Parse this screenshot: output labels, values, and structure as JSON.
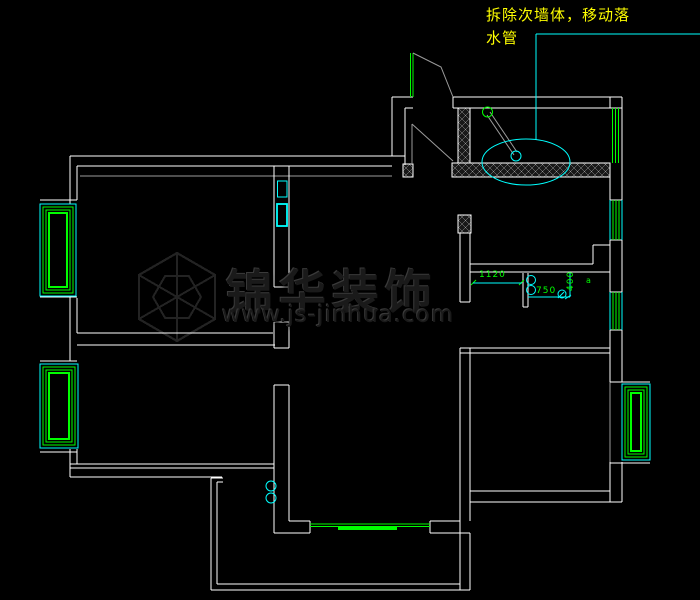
{
  "annotation": {
    "line1": "拆除次墙体，移动落",
    "line2": "水管",
    "color": "#ffff00"
  },
  "watermark": {
    "title": "锦华装饰",
    "url": "www.js-jinhua.com",
    "logo": {
      "cx": 177,
      "cy": 297,
      "r": 44,
      "r2": 24
    }
  },
  "dims": {
    "d1": "1120",
    "d2": "750",
    "d3": "400",
    "marker": "a"
  },
  "colors": {
    "background": "#000000",
    "wall": "#ffffff",
    "window_green": "#00ff00",
    "cyan": "#00ffff",
    "yellow": "#ffff00",
    "dim_text": "#00ff00",
    "gray": "#9c9c9c",
    "watermark": "#232323",
    "hatch": "#b5b5b5"
  },
  "plan": {
    "lines": [
      {
        "x1": 70,
        "y1": 156,
        "x2": 405,
        "y2": 156
      },
      {
        "x1": 77,
        "y1": 166,
        "x2": 392,
        "y2": 166
      },
      {
        "x1": 70,
        "y1": 156,
        "x2": 70,
        "y2": 204
      },
      {
        "x1": 77,
        "y1": 166,
        "x2": 77,
        "y2": 200
      },
      {
        "x1": 80,
        "y1": 176,
        "x2": 392,
        "y2": 176,
        "c": "gray"
      },
      {
        "x1": 70,
        "y1": 296,
        "x2": 70,
        "y2": 361
      },
      {
        "x1": 77,
        "y1": 298,
        "x2": 77,
        "y2": 333
      },
      {
        "x1": 77,
        "y1": 333,
        "x2": 273,
        "y2": 333
      },
      {
        "x1": 77,
        "y1": 345,
        "x2": 275,
        "y2": 345
      },
      {
        "x1": 70,
        "y1": 449,
        "x2": 70,
        "y2": 477
      },
      {
        "x1": 77,
        "y1": 449,
        "x2": 77,
        "y2": 464
      },
      {
        "x1": 70,
        "y1": 464,
        "x2": 274,
        "y2": 464
      },
      {
        "x1": 70,
        "y1": 468,
        "x2": 274,
        "y2": 468
      },
      {
        "x1": 70,
        "y1": 477,
        "x2": 222,
        "y2": 477
      },
      {
        "x1": 40,
        "y1": 200,
        "x2": 77,
        "y2": 200
      },
      {
        "x1": 40,
        "y1": 204,
        "x2": 70,
        "y2": 204
      },
      {
        "x1": 40,
        "y1": 297,
        "x2": 77,
        "y2": 297
      },
      {
        "x1": 40,
        "y1": 361,
        "x2": 77,
        "y2": 361
      },
      {
        "x1": 40,
        "y1": 364,
        "x2": 70,
        "y2": 364
      },
      {
        "x1": 40,
        "y1": 448,
        "x2": 77,
        "y2": 448
      },
      {
        "x1": 40,
        "y1": 452,
        "x2": 77,
        "y2": 452
      },
      {
        "x1": 274,
        "y1": 166,
        "x2": 274,
        "y2": 287
      },
      {
        "x1": 274,
        "y1": 322,
        "x2": 274,
        "y2": 348
      },
      {
        "x1": 274,
        "y1": 385,
        "x2": 274,
        "y2": 533
      },
      {
        "x1": 289,
        "y1": 166,
        "x2": 289,
        "y2": 287
      },
      {
        "x1": 289,
        "y1": 322,
        "x2": 289,
        "y2": 348
      },
      {
        "x1": 289,
        "y1": 385,
        "x2": 289,
        "y2": 521
      },
      {
        "x1": 274,
        "y1": 287,
        "x2": 289,
        "y2": 287
      },
      {
        "x1": 274,
        "y1": 322,
        "x2": 289,
        "y2": 322
      },
      {
        "x1": 274,
        "y1": 348,
        "x2": 289,
        "y2": 348
      },
      {
        "x1": 274,
        "y1": 385,
        "x2": 289,
        "y2": 385
      },
      {
        "x1": 289,
        "y1": 521,
        "x2": 310,
        "y2": 521
      },
      {
        "x1": 274,
        "y1": 533,
        "x2": 310,
        "y2": 533
      },
      {
        "x1": 310,
        "y1": 521,
        "x2": 310,
        "y2": 533
      },
      {
        "x1": 430,
        "y1": 521,
        "x2": 460,
        "y2": 521
      },
      {
        "x1": 430,
        "y1": 533,
        "x2": 470,
        "y2": 533
      },
      {
        "x1": 430,
        "y1": 521,
        "x2": 430,
        "y2": 533
      },
      {
        "x1": 211,
        "y1": 478,
        "x2": 211,
        "y2": 590,
        "n": "balcony-wall"
      },
      {
        "x1": 211,
        "y1": 478,
        "x2": 223,
        "y2": 478
      },
      {
        "x1": 217,
        "y1": 482,
        "x2": 217,
        "y2": 584
      },
      {
        "x1": 217,
        "y1": 482,
        "x2": 223,
        "y2": 482
      },
      {
        "x1": 211,
        "y1": 590,
        "x2": 470,
        "y2": 590,
        "n": "balcony-wall"
      },
      {
        "x1": 217,
        "y1": 584,
        "x2": 460,
        "y2": 584
      },
      {
        "x1": 460,
        "y1": 233,
        "x2": 460,
        "y2": 302
      },
      {
        "x1": 470,
        "y1": 233,
        "x2": 470,
        "y2": 302
      },
      {
        "x1": 460,
        "y1": 302,
        "x2": 470,
        "y2": 302
      },
      {
        "x1": 460,
        "y1": 348,
        "x2": 460,
        "y2": 590
      },
      {
        "x1": 470,
        "y1": 348,
        "x2": 470,
        "y2": 521
      },
      {
        "x1": 470,
        "y1": 533,
        "x2": 470,
        "y2": 590
      },
      {
        "x1": 470,
        "y1": 264,
        "x2": 593,
        "y2": 264
      },
      {
        "x1": 470,
        "y1": 272,
        "x2": 610,
        "y2": 272
      },
      {
        "x1": 593,
        "y1": 245,
        "x2": 593,
        "y2": 264
      },
      {
        "x1": 593,
        "y1": 245,
        "x2": 610,
        "y2": 245
      },
      {
        "x1": 460,
        "y1": 348,
        "x2": 610,
        "y2": 348
      },
      {
        "x1": 460,
        "y1": 353,
        "x2": 610,
        "y2": 353
      },
      {
        "x1": 470,
        "y1": 491,
        "x2": 610,
        "y2": 491
      },
      {
        "x1": 470,
        "y1": 502,
        "x2": 622,
        "y2": 502
      },
      {
        "x1": 610,
        "y1": 491,
        "x2": 610,
        "y2": 502
      },
      {
        "x1": 622,
        "y1": 97,
        "x2": 622,
        "y2": 382
      },
      {
        "x1": 622,
        "y1": 462,
        "x2": 622,
        "y2": 502
      },
      {
        "x1": 610,
        "y1": 97,
        "x2": 610,
        "y2": 108
      },
      {
        "x1": 610,
        "y1": 177,
        "x2": 610,
        "y2": 200
      },
      {
        "x1": 610,
        "y1": 240,
        "x2": 610,
        "y2": 292
      },
      {
        "x1": 610,
        "y1": 330,
        "x2": 610,
        "y2": 382
      },
      {
        "x1": 610,
        "y1": 462,
        "x2": 610,
        "y2": 491
      },
      {
        "x1": 610,
        "y1": 382,
        "x2": 610,
        "y2": 462,
        "c": "gray"
      },
      {
        "x1": 453,
        "y1": 97,
        "x2": 622,
        "y2": 97
      },
      {
        "x1": 453,
        "y1": 97,
        "x2": 453,
        "y2": 108
      },
      {
        "x1": 453,
        "y1": 108,
        "x2": 610,
        "y2": 108
      },
      {
        "x1": 610,
        "y1": 200,
        "x2": 622,
        "y2": 200
      },
      {
        "x1": 610,
        "y1": 240,
        "x2": 622,
        "y2": 240
      },
      {
        "x1": 610,
        "y1": 292,
        "x2": 622,
        "y2": 292
      },
      {
        "x1": 610,
        "y1": 330,
        "x2": 622,
        "y2": 330
      },
      {
        "x1": 610,
        "y1": 108,
        "x2": 622,
        "y2": 108
      },
      {
        "x1": 610,
        "y1": 382,
        "x2": 650,
        "y2": 382
      },
      {
        "x1": 610,
        "y1": 463,
        "x2": 650,
        "y2": 463
      },
      {
        "x1": 392,
        "y1": 97,
        "x2": 392,
        "y2": 156
      },
      {
        "x1": 405,
        "y1": 108,
        "x2": 405,
        "y2": 165
      },
      {
        "x1": 392,
        "y1": 97,
        "x2": 413,
        "y2": 97
      },
      {
        "x1": 405,
        "y1": 108,
        "x2": 413,
        "y2": 108
      },
      {
        "x1": 523,
        "y1": 273,
        "x2": 523,
        "y2": 307
      },
      {
        "x1": 528,
        "y1": 273,
        "x2": 528,
        "y2": 307
      },
      {
        "x1": 523,
        "y1": 307,
        "x2": 528,
        "y2": 307
      },
      {
        "x1": 410.5,
        "y1": 53,
        "x2": 410.5,
        "y2": 97,
        "c": "green",
        "n": "window-line"
      },
      {
        "x1": 413,
        "y1": 53,
        "x2": 413,
        "y2": 97,
        "c": "green",
        "n": "window-line"
      },
      {
        "x1": 310,
        "y1": 524,
        "x2": 430,
        "y2": 524,
        "c": "green",
        "n": "sliding-door"
      },
      {
        "x1": 310,
        "y1": 526.5,
        "x2": 430,
        "y2": 526.5,
        "c": "green",
        "n": "sliding-door"
      },
      {
        "x1": 338,
        "y1": 528.5,
        "x2": 397,
        "y2": 528.5,
        "c": "green",
        "sw": 3,
        "n": "sliding-door-panel"
      },
      {
        "x1": 612.5,
        "y1": 108,
        "x2": 612.5,
        "y2": 163,
        "c": "green",
        "n": "window-line"
      },
      {
        "x1": 615.5,
        "y1": 108,
        "x2": 615.5,
        "y2": 163,
        "c": "green",
        "n": "window-line"
      },
      {
        "x1": 618.5,
        "y1": 108,
        "x2": 618.5,
        "y2": 163,
        "c": "green",
        "n": "window-line"
      },
      {
        "x1": 613,
        "y1": 200,
        "x2": 613,
        "y2": 240,
        "c": "green",
        "n": "window-line"
      },
      {
        "x1": 616,
        "y1": 200,
        "x2": 616,
        "y2": 240,
        "c": "green",
        "n": "window-line"
      },
      {
        "x1": 619,
        "y1": 200,
        "x2": 619,
        "y2": 240,
        "c": "green",
        "n": "window-line"
      },
      {
        "x1": 613,
        "y1": 292,
        "x2": 613,
        "y2": 330,
        "c": "green",
        "n": "window-line"
      },
      {
        "x1": 616,
        "y1": 292,
        "x2": 616,
        "y2": 330,
        "c": "green",
        "n": "window-line"
      },
      {
        "x1": 619,
        "y1": 292,
        "x2": 619,
        "y2": 330,
        "c": "green",
        "n": "window-line"
      },
      {
        "x1": 471,
        "y1": 285,
        "x2": 476,
        "y2": 280,
        "c": "green",
        "n": "dim-tick"
      },
      {
        "x1": 519,
        "y1": 285,
        "x2": 524,
        "y2": 280,
        "c": "green",
        "n": "dim-tick"
      },
      {
        "x1": 536,
        "y1": 34,
        "x2": 700,
        "y2": 34,
        "c": "cyan",
        "n": "leader-line"
      },
      {
        "x1": 536,
        "y1": 34,
        "x2": 536,
        "y2": 140,
        "c": "cyan",
        "n": "leader-line"
      },
      {
        "x1": 610,
        "y1": 200,
        "x2": 610,
        "y2": 240,
        "c": "cyan",
        "n": "window-line"
      },
      {
        "x1": 622,
        "y1": 200,
        "x2": 622,
        "y2": 240,
        "c": "cyan",
        "n": "window-line"
      },
      {
        "x1": 610,
        "y1": 292,
        "x2": 610,
        "y2": 330,
        "c": "cyan",
        "n": "window-line"
      },
      {
        "x1": 622,
        "y1": 292,
        "x2": 622,
        "y2": 330,
        "c": "cyan",
        "n": "window-line"
      },
      {
        "x1": 473,
        "y1": 283,
        "x2": 522,
        "y2": 283,
        "c": "cyan",
        "n": "dim-line-1120"
      },
      {
        "x1": 528,
        "y1": 297,
        "x2": 570,
        "y2": 297,
        "c": "cyan",
        "n": "dim-line-750"
      },
      {
        "x1": 570,
        "y1": 273,
        "x2": 570,
        "y2": 297,
        "c": "cyan",
        "n": "dim-line-400"
      },
      {
        "x1": 565,
        "y1": 299,
        "x2": 571,
        "y2": 295,
        "c": "cyan",
        "n": "dim-arrow"
      },
      {
        "x1": 558,
        "y1": 298,
        "x2": 564,
        "y2": 292,
        "c": "cyan",
        "n": "dim-arrow"
      },
      {
        "x1": 412,
        "y1": 124,
        "x2": 453,
        "y2": 161,
        "c": "gray",
        "n": "angled-wall"
      },
      {
        "x1": 412,
        "y1": 124,
        "x2": 412,
        "y2": 165,
        "c": "gray"
      },
      {
        "x1": 487,
        "y1": 115,
        "x2": 514,
        "y2": 155,
        "c": "gray",
        "n": "shower-arm"
      },
      {
        "x1": 490,
        "y1": 112,
        "x2": 517,
        "y2": 152,
        "c": "gray",
        "n": "shower-arm"
      }
    ],
    "polylines": [
      {
        "pts": "413,53 441,67 453,97",
        "c": "gray",
        "n": "angled-wall"
      }
    ],
    "hatch_rects": [
      {
        "x": 458,
        "y": 108,
        "w": 12,
        "h": 55,
        "n": "hatched-wall-column"
      },
      {
        "x": 452,
        "y": 163,
        "w": 158,
        "h": 14,
        "n": "hatched-wall-band"
      },
      {
        "x": 403,
        "y": 164,
        "w": 10,
        "h": 13,
        "n": "hatched-wall-pier"
      },
      {
        "x": 458,
        "y": 215,
        "w": 13,
        "h": 18,
        "n": "hatched-wall-column"
      }
    ],
    "rects": [
      {
        "x": 277.5,
        "y": 181,
        "w": 9.5,
        "h": 16,
        "c": "cyan",
        "n": "flue-box"
      },
      {
        "x": 277,
        "y": 204,
        "w": 10,
        "h": 22,
        "c": "cyan",
        "sw": 1.8,
        "n": "flue-box"
      },
      {
        "x": 40,
        "y": 204,
        "w": 36,
        "h": 92,
        "c": "cyan",
        "n": "bay-window-frame"
      },
      {
        "x": 43,
        "y": 207,
        "w": 30,
        "h": 86,
        "c": "green",
        "n": "bay-window-frame"
      },
      {
        "x": 46,
        "y": 210,
        "w": 24,
        "h": 80,
        "c": "green",
        "n": "bay-window-frame"
      },
      {
        "x": 49,
        "y": 213,
        "w": 18,
        "h": 74,
        "c": "green",
        "sw": 2,
        "n": "bay-window-frame"
      },
      {
        "x": 40,
        "y": 364,
        "w": 38,
        "h": 84,
        "c": "cyan",
        "n": "bay-window-frame"
      },
      {
        "x": 43,
        "y": 367,
        "w": 32,
        "h": 78,
        "c": "green",
        "n": "bay-window-frame"
      },
      {
        "x": 46,
        "y": 370,
        "w": 26,
        "h": 72,
        "c": "green",
        "n": "bay-window-frame"
      },
      {
        "x": 49,
        "y": 373,
        "w": 20,
        "h": 66,
        "c": "green",
        "sw": 2,
        "n": "bay-window-frame"
      },
      {
        "x": 622,
        "y": 384,
        "w": 28,
        "h": 76,
        "c": "cyan",
        "n": "bay-window-frame"
      },
      {
        "x": 625,
        "y": 387,
        "w": 22,
        "h": 70,
        "c": "green",
        "n": "bay-window-frame"
      },
      {
        "x": 628,
        "y": 390,
        "w": 16,
        "h": 64,
        "c": "green",
        "n": "bay-window-frame"
      },
      {
        "x": 631,
        "y": 393,
        "w": 10,
        "h": 58,
        "c": "green",
        "sw": 2,
        "n": "bay-window-frame"
      }
    ],
    "circles": [
      {
        "cx": 487.5,
        "cy": 112,
        "r": 5,
        "c": "green",
        "n": "shower-head"
      },
      {
        "cx": 516,
        "cy": 156,
        "r": 5,
        "c": "cyan",
        "n": "drain"
      },
      {
        "cx": 531,
        "cy": 280,
        "r": 4.5,
        "c": "cyan",
        "n": "symbol-circle"
      },
      {
        "cx": 531,
        "cy": 290,
        "r": 4.5,
        "c": "cyan",
        "n": "symbol-circle"
      },
      {
        "cx": 562,
        "cy": 294,
        "r": 4,
        "c": "cyan",
        "n": "symbol-circle"
      },
      {
        "cx": 271,
        "cy": 486,
        "r": 5,
        "c": "cyan",
        "n": "symbol-circle"
      },
      {
        "cx": 271,
        "cy": 498,
        "r": 5,
        "c": "cyan",
        "n": "symbol-circle"
      }
    ],
    "ellipses": [
      {
        "cx": 526,
        "cy": 162,
        "rx": 44,
        "ry": 23,
        "c": "cyan",
        "n": "bathtub"
      }
    ]
  }
}
